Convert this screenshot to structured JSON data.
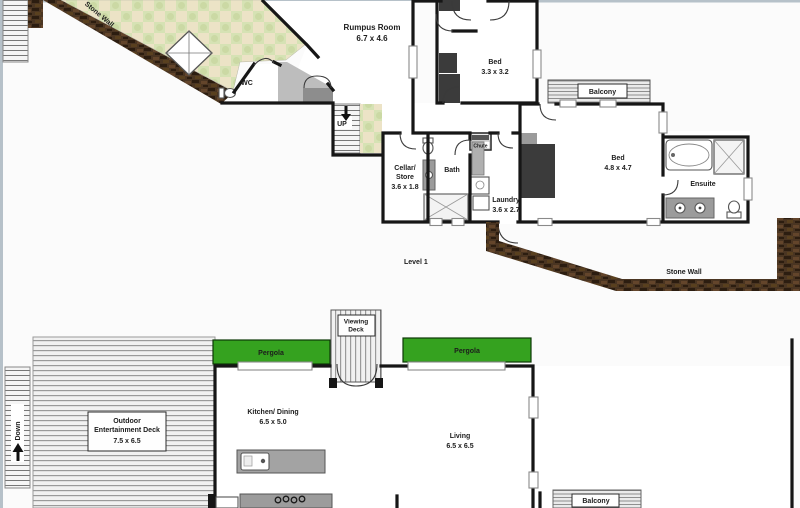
{
  "colors": {
    "pergola_green": "#35a21f",
    "stone_wall_brown": "#4a3522",
    "wall_black": "#161616",
    "patio_green": "#d6e2b4",
    "patio_tan": "#ece3c6"
  },
  "upper": {
    "level_label": "Level 1",
    "stone_wall_top": "Stone Wall",
    "stone_wall_bottom": "Stone Wall",
    "rumpus_name": "Rumpus Room",
    "rumpus_dims": "6.7 x 4.6",
    "wc": "WC",
    "up": "UP",
    "cellar_line1": "Cellar/",
    "cellar_line2": "Store",
    "cellar_dims": "3.6 x 1.8",
    "bath": "Bath",
    "chute": "Chute",
    "laundry_name": "Laundry",
    "laundry_dims": "3.6 x 2.7",
    "bed_small_name": "Bed",
    "bed_small_dims": "3.3 x 3.2",
    "bed_main_name": "Bed",
    "bed_main_dims": "4.8 x 4.7",
    "balcony": "Balcony",
    "ensuite": "Ensuite"
  },
  "lower": {
    "down": "Down",
    "deck_line1": "Outdoor",
    "deck_line2": "Entertainment Deck",
    "deck_dims": "7.5 x 6.5",
    "pergola_left": "Pergola",
    "pergola_right": "Pergola",
    "viewing_line1": "Viewing",
    "viewing_line2": "Deck",
    "kitchen_name": "Kitchen/ Dining",
    "kitchen_dims": "6.5 x 5.0",
    "living_name": "Living",
    "living_dims": "6.5 x 6.5",
    "balcony": "Balcony"
  }
}
